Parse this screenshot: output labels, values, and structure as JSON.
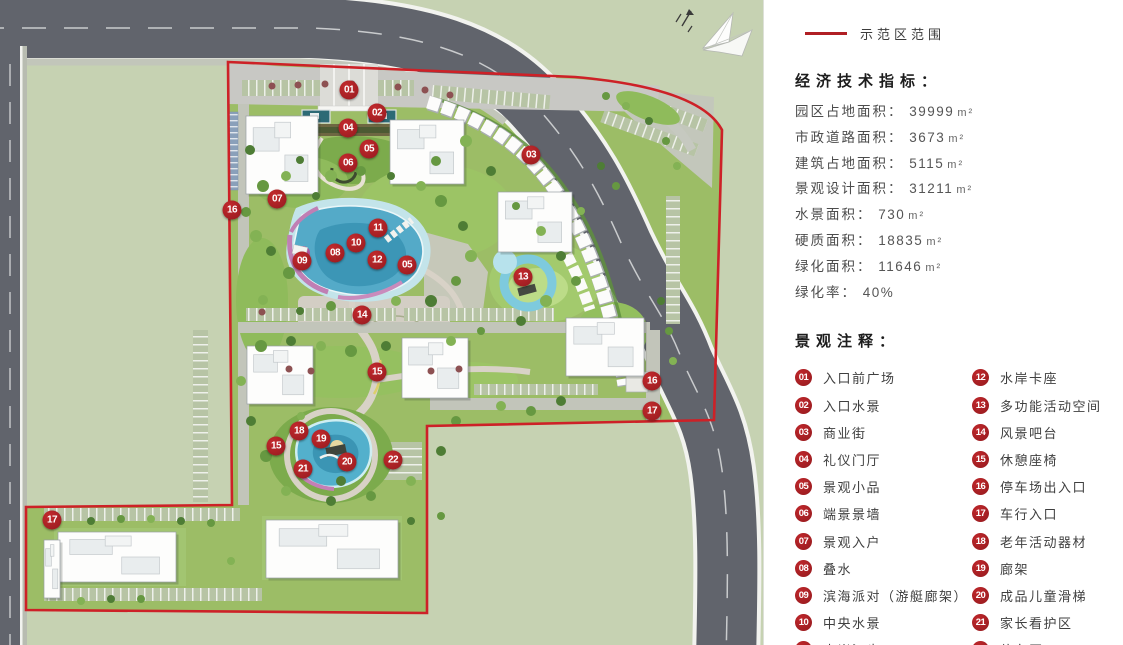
{
  "legend": {
    "boundary_label": "示范区范围",
    "boundary_color": "#cd2127"
  },
  "indicators": {
    "title": "经济技术指标：",
    "items": [
      {
        "label": "园区占地面积：",
        "value": "39999",
        "unit": "m²"
      },
      {
        "label": "市政道路面积：",
        "value": "3673",
        "unit": "m²"
      },
      {
        "label": "建筑占地面积：",
        "value": "5115",
        "unit": "m²"
      },
      {
        "label": "景观设计面积：",
        "value": "31211",
        "unit": "m²"
      },
      {
        "label": "水景面积：",
        "value": "730",
        "unit": "m²"
      },
      {
        "label": "硬质面积：",
        "value": "18835",
        "unit": "m²"
      },
      {
        "label": "绿化面积：",
        "value": "11646",
        "unit": "m²"
      },
      {
        "label": "绿化率：",
        "value": "40%",
        "unit": ""
      }
    ]
  },
  "annotations": {
    "title": "景观注释：",
    "items": [
      {
        "num": "01",
        "label": "入口前广场"
      },
      {
        "num": "02",
        "label": "入口水景"
      },
      {
        "num": "03",
        "label": "商业街"
      },
      {
        "num": "04",
        "label": "礼仪门厅"
      },
      {
        "num": "05",
        "label": "景观小品"
      },
      {
        "num": "06",
        "label": "端景景墙"
      },
      {
        "num": "07",
        "label": "景观入户"
      },
      {
        "num": "08",
        "label": "叠水"
      },
      {
        "num": "09",
        "label": "滨海派对（游艇廊架）"
      },
      {
        "num": "10",
        "label": "中央水景"
      },
      {
        "num": "11",
        "label": "水岸汀步"
      },
      {
        "num": "12",
        "label": "水岸卡座"
      },
      {
        "num": "13",
        "label": "多功能活动空间"
      },
      {
        "num": "14",
        "label": "风景吧台"
      },
      {
        "num": "15",
        "label": "休憩座椅"
      },
      {
        "num": "16",
        "label": "停车场出入口"
      },
      {
        "num": "17",
        "label": "车行入口"
      },
      {
        "num": "18",
        "label": "老年活动器材"
      },
      {
        "num": "19",
        "label": "廊架"
      },
      {
        "num": "20",
        "label": "成品儿童滑梯"
      },
      {
        "num": "21",
        "label": "家长看护区"
      },
      {
        "num": "22",
        "label": "停车区"
      }
    ]
  },
  "plan": {
    "marker_color": "#a92125",
    "markers": [
      {
        "num": "01",
        "x": 349,
        "y": 90
      },
      {
        "num": "02",
        "x": 377,
        "y": 113
      },
      {
        "num": "04",
        "x": 348,
        "y": 128
      },
      {
        "num": "05",
        "x": 369,
        "y": 149
      },
      {
        "num": "06",
        "x": 348,
        "y": 163
      },
      {
        "num": "03",
        "x": 531,
        "y": 155
      },
      {
        "num": "07",
        "x": 277,
        "y": 199
      },
      {
        "num": "16",
        "x": 232,
        "y": 210
      },
      {
        "num": "11",
        "x": 378,
        "y": 228
      },
      {
        "num": "10",
        "x": 356,
        "y": 243
      },
      {
        "num": "08",
        "x": 335,
        "y": 253
      },
      {
        "num": "09",
        "x": 302,
        "y": 261
      },
      {
        "num": "12",
        "x": 377,
        "y": 260
      },
      {
        "num": "05",
        "x": 407,
        "y": 265
      },
      {
        "num": "13",
        "x": 523,
        "y": 277
      },
      {
        "num": "14",
        "x": 362,
        "y": 315
      },
      {
        "num": "15",
        "x": 377,
        "y": 372
      },
      {
        "num": "16",
        "x": 652,
        "y": 381
      },
      {
        "num": "17",
        "x": 652,
        "y": 411
      },
      {
        "num": "18",
        "x": 299,
        "y": 431
      },
      {
        "num": "19",
        "x": 321,
        "y": 439
      },
      {
        "num": "15",
        "x": 276,
        "y": 446
      },
      {
        "num": "20",
        "x": 347,
        "y": 462
      },
      {
        "num": "21",
        "x": 303,
        "y": 469
      },
      {
        "num": "22",
        "x": 393,
        "y": 460
      },
      {
        "num": "17",
        "x": 52,
        "y": 520
      }
    ]
  }
}
